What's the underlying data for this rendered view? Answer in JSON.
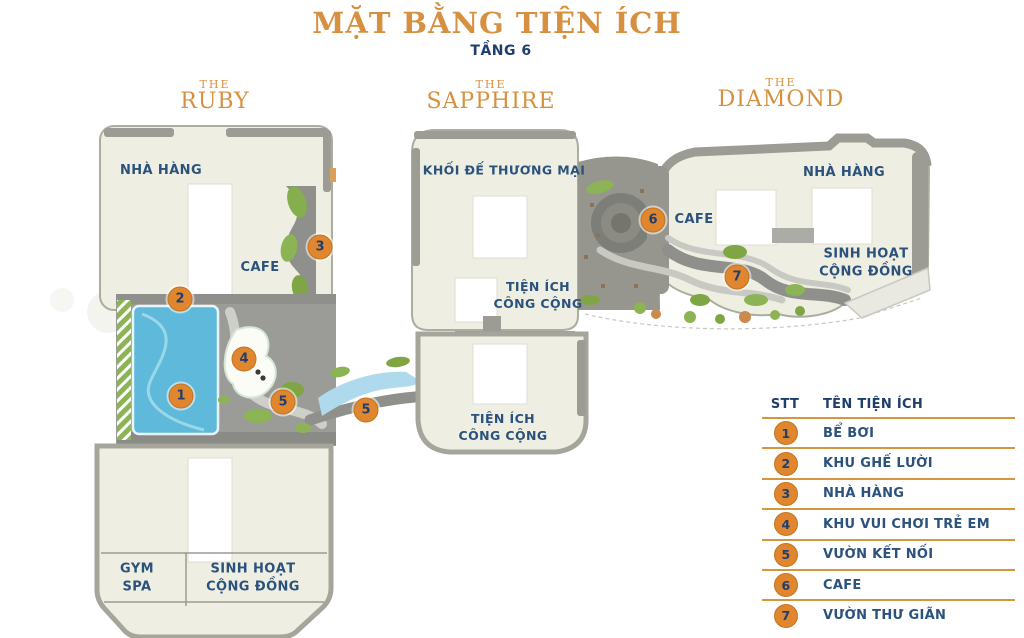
{
  "header": {
    "title": "MẶT BẰNG TIỆN ÍCH",
    "subtitle": "TẦNG 6"
  },
  "towers": [
    {
      "pre": "THE",
      "name": "RUBY"
    },
    {
      "pre": "THE",
      "name": "SAPPHIRE"
    },
    {
      "pre": "THE",
      "name": "DIAMOND"
    }
  ],
  "map_labels": {
    "ruby_restaurant": "NHÀ HÀNG",
    "ruby_cafe": "CAFE",
    "ruby_gym_line1": "GYM",
    "ruby_gym_line2": "SPA",
    "ruby_community_line1": "SINH HOẠT",
    "ruby_community_line2": "CỘNG ĐỒNG",
    "sapphire_commercial": "KHỐI ĐẾ THƯƠNG MẠI",
    "sapphire_public1_line1": "TIỆN ÍCH",
    "sapphire_public1_line2": "CÔNG CỘNG",
    "sapphire_public2_line1": "TIỆN ÍCH",
    "sapphire_public2_line2": "CÔNG CỘNG",
    "diamond_cafe": "CAFE",
    "diamond_restaurant": "NHÀ HÀNG",
    "diamond_community_line1": "SINH HOẠT",
    "diamond_community_line2": "CỘNG ĐỒNG"
  },
  "markers": [
    "1",
    "2",
    "3",
    "4",
    "5",
    "5",
    "6",
    "7"
  ],
  "legend": {
    "col_num": "STT",
    "col_name": "TÊN TIỆN ÍCH",
    "rows": [
      {
        "num": "1",
        "name": "BỂ BƠI"
      },
      {
        "num": "2",
        "name": "KHU GHẾ LƯỜI"
      },
      {
        "num": "3",
        "name": "NHÀ HÀNG"
      },
      {
        "num": "4",
        "name": "KHU VUI CHƠI TRẺ EM"
      },
      {
        "num": "5",
        "name": "VƯỜN KẾT NỐI"
      },
      {
        "num": "6",
        "name": "CAFE"
      },
      {
        "num": "7",
        "name": "VƯỜN THƯ GIÃN"
      }
    ]
  },
  "colors": {
    "accent_orange": "#D6903F",
    "marker_orange": "#E0862F",
    "navy": "#2A527C",
    "pool_blue": "#5FB9DA",
    "building_cream": "#EFEEE2"
  }
}
